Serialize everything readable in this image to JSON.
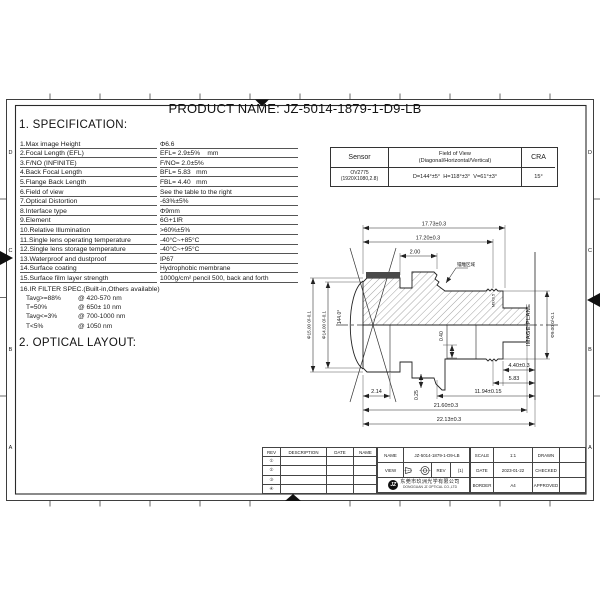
{
  "colors": {
    "line": "#222222",
    "paper": "#ffffff",
    "coating_strip": "#4a4a4a"
  },
  "product": {
    "title": "PRODUCT NAME: JZ-5014-1879-1-D9-LB"
  },
  "sections": {
    "spec_heading": "1. SPECIFICATION:",
    "layout_heading": "2. OPTICAL LAYOUT:"
  },
  "spec": {
    "rows": [
      {
        "label": "1.Max image Height",
        "value": "Φ6.6"
      },
      {
        "label": "2.Focal Length (EFL)",
        "value": "EFL= 2.9±5%    mm"
      },
      {
        "label": "3.F/NO (INFINITE)",
        "value": "F/NO= 2.0±5%"
      },
      {
        "label": "4.Back Focal Length",
        "value": "BFL= 5.83   mm"
      },
      {
        "label": "5.Flange Back Length",
        "value": "FBL= 4.40   mm"
      },
      {
        "label": "6.Field of view",
        "value": "See the table to the right"
      },
      {
        "label": "7.Optical Distortion",
        "value": "-63%±5%"
      },
      {
        "label": "8.Interface type",
        "value": "Φ9mm"
      },
      {
        "label": "9.Element",
        "value": "6G+1IR"
      },
      {
        "label": "10.Relative Illumination",
        "value": ">60%±5%"
      },
      {
        "label": "11.Single lens operating temperature",
        "value": "-40°C~+85°C"
      },
      {
        "label": "12.Single lens storage temperature",
        "value": "-40°C~+95°C"
      },
      {
        "label": "13.Waterproof and dustproof",
        "value": "IP67"
      },
      {
        "label": "14.Surface coating",
        "value": "Hydrophobic membrane"
      },
      {
        "label": "15.Surface film layer strength",
        "value": "1000g/cm² pencil 500, back and forth"
      }
    ],
    "filter_title": "16.IR FILTER SPEC.(Built-in,Others available)",
    "filter_rows": [
      {
        "t": "Tavg>=88%",
        "w": "@ 420-570 nm"
      },
      {
        "t": "T=50%",
        "w": "@ 650± 10 nm"
      },
      {
        "t": "Tavg<=3%",
        "w": "@ 700-1000 nm"
      },
      {
        "t": "T<5%",
        "w": "@ 1050 nm"
      }
    ]
  },
  "sensor_table": {
    "headers": {
      "sensor": "Sensor",
      "fov_line1": "Field of View",
      "fov_line2": "(Diagonal/Horizontal/Vertical)",
      "cra": "CRA"
    },
    "row": {
      "sensor_line1": "OV2775",
      "sensor_line2": "(1920X1080,2.8)",
      "fov": "D=144°±5°  H=118°±3°  V=61°±3°",
      "cra": "15°"
    }
  },
  "drawing": {
    "dims": {
      "d1773": "17.73±0.3",
      "d1720": "17.20±0.3",
      "d200": "2.00",
      "d15": "Φ15.00 0/-0.1",
      "d14": "Φ14.00 0/-0.1",
      "angle": "144.0°",
      "d9": "Φ9.00 0/-0.1",
      "d040": "0.40",
      "d440": "4.40±0.3",
      "d583": "5.83",
      "d214": "2.14",
      "d025": "0.25",
      "d1194": "11.94±0.15",
      "d2160": "21.60±0.3",
      "d2213": "22.13±0.3"
    },
    "labels": {
      "image_plane": "IMAGE PLANE",
      "laser_area": "镭雕区域",
      "thread": "M9X0.5"
    }
  },
  "zones": {
    "left": [
      "D",
      "C",
      "B",
      "A"
    ],
    "right": [
      "D",
      "C",
      "B",
      "A"
    ]
  },
  "title_block": {
    "rev_headers": [
      "REV",
      "DESCRIPTION",
      "DATE",
      "NAME"
    ],
    "rev_rows": [
      "①",
      "②",
      "③",
      "④"
    ],
    "name_label": "NAME",
    "name_value": "JZ-5014-1879-1-D9-LB",
    "view_label": "VIEW",
    "rev_label": "REV",
    "rev_value": "(1)",
    "logo_text": "JZ",
    "company_cn": "东莞市玖洲光学有限公司",
    "company_en": "DONGGUAN JZ OPTICAL CO.,LTD",
    "scale_label": "SCALE",
    "scale_value": "1:1",
    "date_label": "DATE",
    "date_value": "2023-01-22",
    "border_label": "BORDER",
    "border_value": "A4",
    "drawn_label": "DRAWN",
    "checked_label": "CHECKED",
    "approved_label": "APPROVED"
  }
}
